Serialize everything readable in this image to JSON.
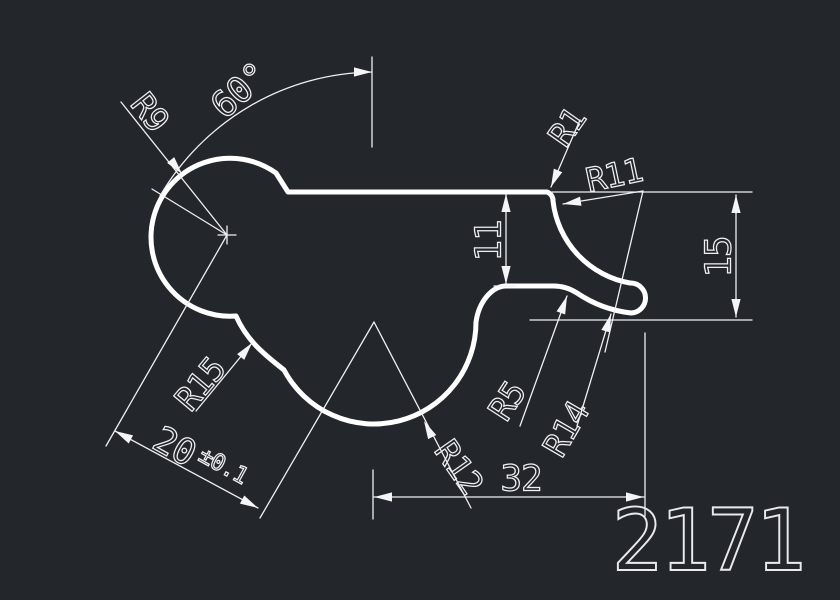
{
  "app": {
    "type": "cad-drawing-canvas",
    "background_color": "#23262b",
    "line_color": "#ffffff"
  },
  "drawing": {
    "part_number": "2171",
    "labels": {
      "angle": "60°",
      "r9": "R9",
      "r1": "R1",
      "r11": "R11",
      "r15": "R15",
      "r5": "R5",
      "r12": "R12",
      "r14": "R14",
      "len11": "11",
      "len15": "15",
      "len32": "32",
      "len20": "20",
      "len20_tol": "±0.1"
    }
  }
}
